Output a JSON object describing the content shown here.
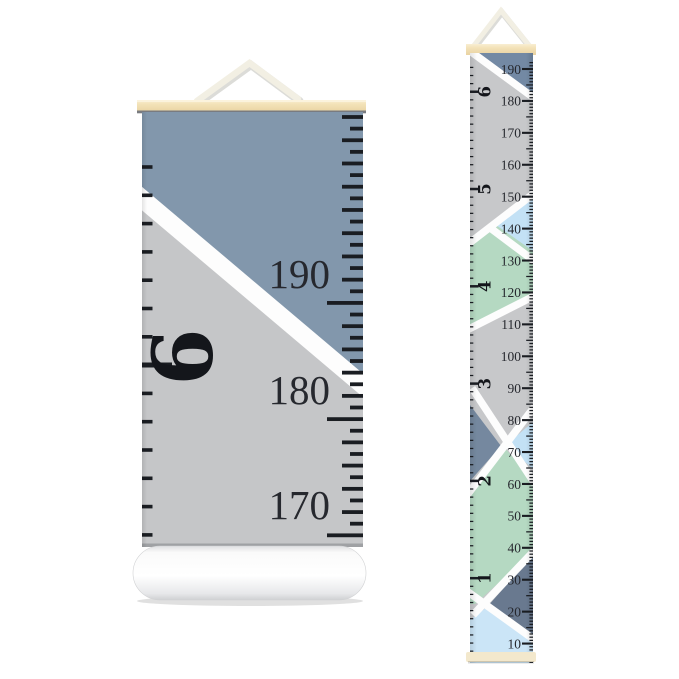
{
  "product": {
    "description": "Hanging canvas growth chart ruler - closeup view and full view",
    "closeup": {
      "cm_labels": [
        "190",
        "180",
        "170"
      ],
      "foot_label": "6"
    },
    "ruler": {
      "cm_labels": [
        "190",
        "180",
        "170",
        "160",
        "150",
        "140",
        "130",
        "120",
        "110",
        "100",
        "90",
        "80",
        "70",
        "60",
        "50",
        "40",
        "30",
        "20",
        "10"
      ],
      "feet_labels": [
        "6",
        "5",
        "4",
        "3",
        "2",
        "1"
      ]
    }
  },
  "colors": {
    "page_bg": "#ffffff",
    "slate_blue_closeup": "#8297ac",
    "slate_blue_top": "#7389a4",
    "slate_blue_mid": "#75889f",
    "slate_blue_deep": "#69798f",
    "canvas_gray": "#c5c6c8",
    "canvas_gray_full": "#c7c8ca",
    "mint_green": "#b5d9c2",
    "light_blue": "#c3e1f5",
    "light_blue_pale": "#cbe5f7",
    "stripe_white": "#fdfdfd",
    "wood_tan": "#f3e2b8",
    "wood_bottom_bar": "#f3e8cc",
    "string_cream": "#f2efe3",
    "tick_ink": "#1a1d22",
    "label_ink": "#26282e",
    "numeral_ink": "#14161b"
  }
}
